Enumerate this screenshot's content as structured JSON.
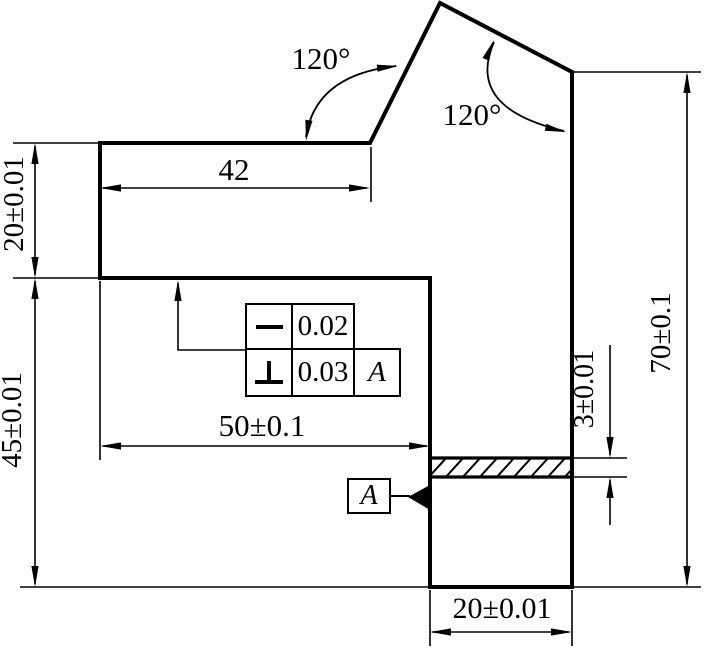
{
  "drawing": {
    "labels": {
      "angle_top_left": "120°",
      "angle_top_right": "120°",
      "width_top": "42",
      "height_step_left": "20±0.01",
      "height_lower_left": "45±0.01",
      "width_middle": "50±0.1",
      "slot_height": "3±0.01",
      "height_right": "70±0.1",
      "width_bottom": "20±0.01"
    },
    "feature_control_frames": [
      {
        "symbol": "straightness",
        "tolerance": "0.02"
      },
      {
        "symbol": "perpendicularity",
        "tolerance": "0.03",
        "datum": "A"
      }
    ],
    "datum": {
      "label": "A"
    },
    "colors": {
      "line": "#000000",
      "background": "#ffffff"
    }
  }
}
